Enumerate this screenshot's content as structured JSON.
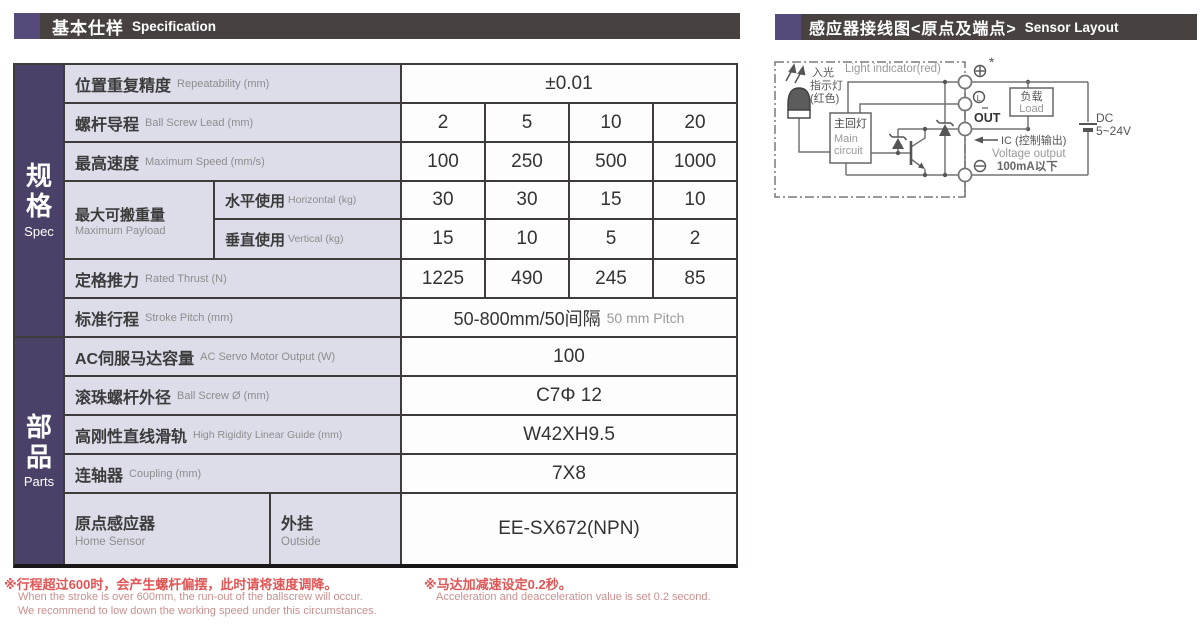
{
  "headers": {
    "left": {
      "zh": "基本仕样",
      "en": "Specification"
    },
    "right": {
      "zh": "感应器接线图<原点及端点>",
      "en": "Sensor Layout"
    }
  },
  "spec_table": {
    "sidebar": {
      "spec": {
        "zh": "规格",
        "en": "Spec"
      },
      "parts": {
        "zh": "部品",
        "en": "Parts"
      }
    },
    "rows": {
      "repeatability": {
        "zh": "位置重复精度",
        "en": "Repeatability (mm)",
        "value": "±0.01"
      },
      "lead": {
        "zh": "螺杆导程",
        "en": "Ball Screw Lead (mm)",
        "values": [
          "2",
          "5",
          "10",
          "20"
        ]
      },
      "speed": {
        "zh": "最高速度",
        "en": "Maximum Speed (mm/s)",
        "values": [
          "100",
          "250",
          "500",
          "1000"
        ]
      },
      "payload": {
        "zh": "最大可搬重量",
        "en": "Maximum Payload",
        "horizontal": {
          "zh": "水平使用",
          "en": "Horizontal (kg)",
          "values": [
            "30",
            "30",
            "15",
            "10"
          ]
        },
        "vertical": {
          "zh": "垂直使用",
          "en": "Vertical (kg)",
          "values": [
            "15",
            "10",
            "5",
            "2"
          ]
        }
      },
      "thrust": {
        "zh": "定格推力",
        "en": "Rated Thrust (N)",
        "values": [
          "1225",
          "490",
          "245",
          "85"
        ]
      },
      "stroke": {
        "zh": "标准行程",
        "en": "Stroke Pitch (mm)",
        "value_main": "50-800mm/50间隔",
        "value_sub": "50 mm Pitch"
      },
      "motor": {
        "zh": "AC伺服马达容量",
        "en": "AC Servo Motor Output (W)",
        "value": "100"
      },
      "screw_od": {
        "zh": "滚珠螺杆外径",
        "en": "Ball Screw Ø (mm)",
        "value": "C7Φ 12"
      },
      "guide": {
        "zh": "高刚性直线滑轨",
        "en": "High Rigidity Linear Guide (mm)",
        "value": "W42XH9.5"
      },
      "coupling": {
        "zh": "连轴器",
        "en": "Coupling (mm)",
        "value": "7X8"
      },
      "home_sensor": {
        "zh": "原点感应器",
        "en": "Home Sensor",
        "sub_zh": "外挂",
        "sub_en": "Outside",
        "value": "EE-SX672(NPN)"
      }
    }
  },
  "notes": {
    "note1_zh": "※行程超过600时，会产生螺杆偏摆，此时请将速度调降。",
    "note1_en1": "When the stroke is over 600mm, the run-out of the ballscrew will occur.",
    "note1_en2": "We recommend to low down the working speed under this circumstances.",
    "note2_zh": "※马达加减速设定0.2秒。",
    "note2_en": "Acceleration and deacceleration value is set 0.2 second."
  },
  "diagram": {
    "light_indicator_en": "Light indicator(red)",
    "incident_line1": "入光",
    "incident_line2": "指示灯",
    "incident_line3": "(红色)",
    "main_circuit_zh": "主回灯",
    "main_circuit_en1": "Main",
    "main_circuit_en2": "circuit",
    "star": "*",
    "terminal_l": "L",
    "out_label": "OUT",
    "ic_label": "IC (控制输出)",
    "voltage_label": "Voltage output",
    "current_label": "100mA以下",
    "load_zh": "负载",
    "load_en": "Load",
    "dc_line1": "DC",
    "dc_line2": "5~24V"
  },
  "colors": {
    "accent_purple": "#564a7b",
    "header_bar_bg": "#474140",
    "sidebar_bg": "#4b4168",
    "label_cell_bg": "#dcdde9",
    "grid_border": "#3f3b3a",
    "note_red": "#e05555",
    "note_pink": "#c9908e"
  }
}
